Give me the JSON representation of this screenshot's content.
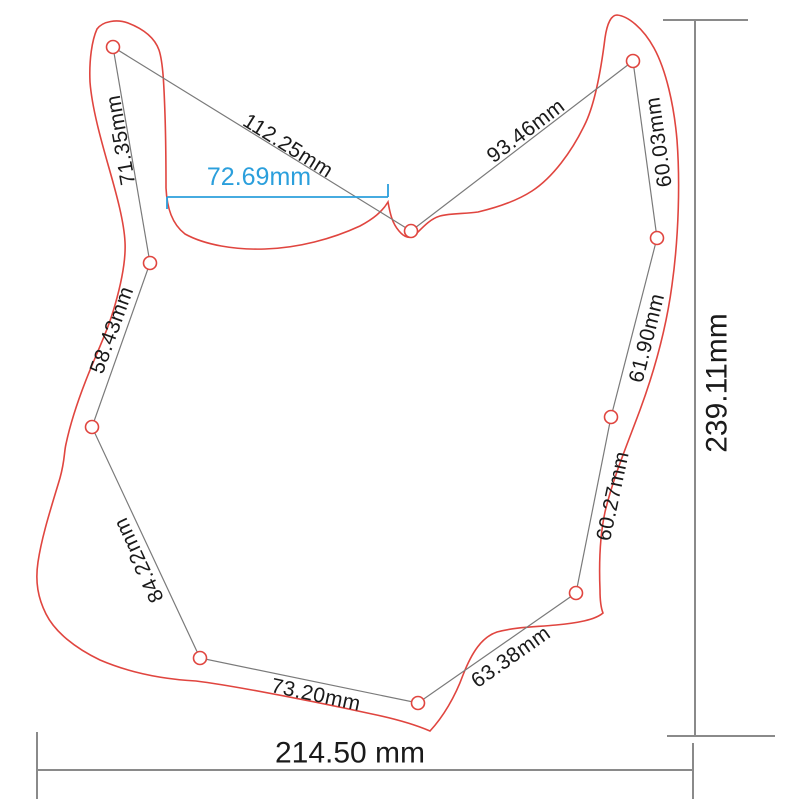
{
  "diagram": {
    "unit": "mm",
    "segment_labels": [
      {
        "value": "112.25mm"
      },
      {
        "value": "93.46mm"
      },
      {
        "value": "60.03mm"
      },
      {
        "value": "61.90mm"
      },
      {
        "value": "60.27mm"
      },
      {
        "value": "63.38mm"
      },
      {
        "value": "73.20mm"
      },
      {
        "value": "84.22mm"
      },
      {
        "value": "58.43mm"
      },
      {
        "value": "71.35mm"
      }
    ],
    "overall_width": "214.50 mm",
    "overall_height": "239.11mm",
    "notch_width": "72.69mm",
    "colors": {
      "outline_red": "#e0453f",
      "measure_gray": "#7a7a7a",
      "dimension_gray": "#8a8a8a",
      "highlight_blue": "#2b9fdc",
      "text_black": "#1a1a1a",
      "background": "#ffffff"
    }
  }
}
